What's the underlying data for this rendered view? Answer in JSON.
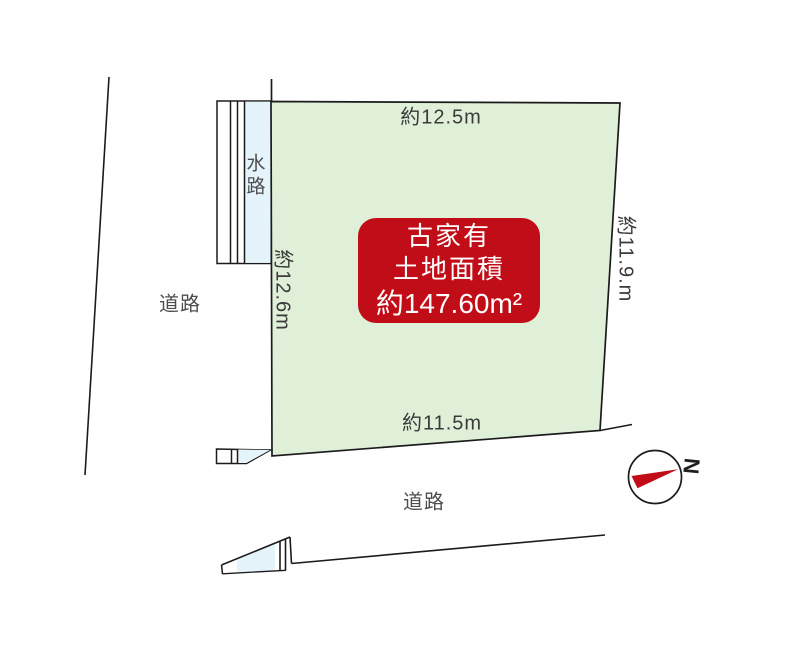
{
  "colors": {
    "plot_fill": "#e0f0d8",
    "water_fill": "#e5f3fb",
    "badge_bg": "#c10d18",
    "needle": "#c10d18",
    "line": "#1b1b1b"
  },
  "plot": {
    "top_dim": "約12.5m",
    "left_dim": "約12.6m",
    "right_dim": "約11.9.m",
    "bottom_dim": "約11.5m"
  },
  "badge": {
    "line1": "古家有",
    "line2": "土地面積",
    "line3": "約147.60m²"
  },
  "labels": {
    "waterway": "水路",
    "road_left": "道路",
    "road_bottom": "道路",
    "north": "N"
  }
}
